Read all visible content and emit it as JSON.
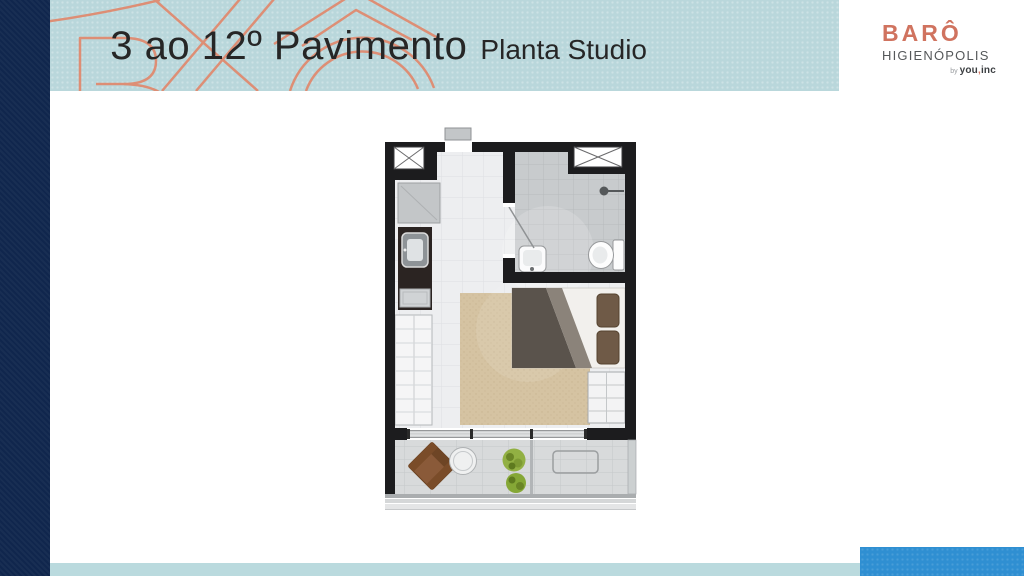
{
  "header": {
    "title_main": "3 ao 12º Pavimento",
    "title_sub": "Planta Studio"
  },
  "logo": {
    "brand": "BARÔ",
    "location": "HIGIENÓPOLIS",
    "by_label": "by",
    "company_you": "you",
    "company_comma": ",",
    "company_inc": "inc"
  },
  "colors": {
    "page": "#ffffff",
    "navy": "#10264d",
    "band": "#b9d7db",
    "curve": "#df8b70",
    "title": "#262626",
    "accent": "#d0735f",
    "logogray": "#55585a",
    "footlight": "#badade",
    "footblue": "#2f8fd2"
  }
}
